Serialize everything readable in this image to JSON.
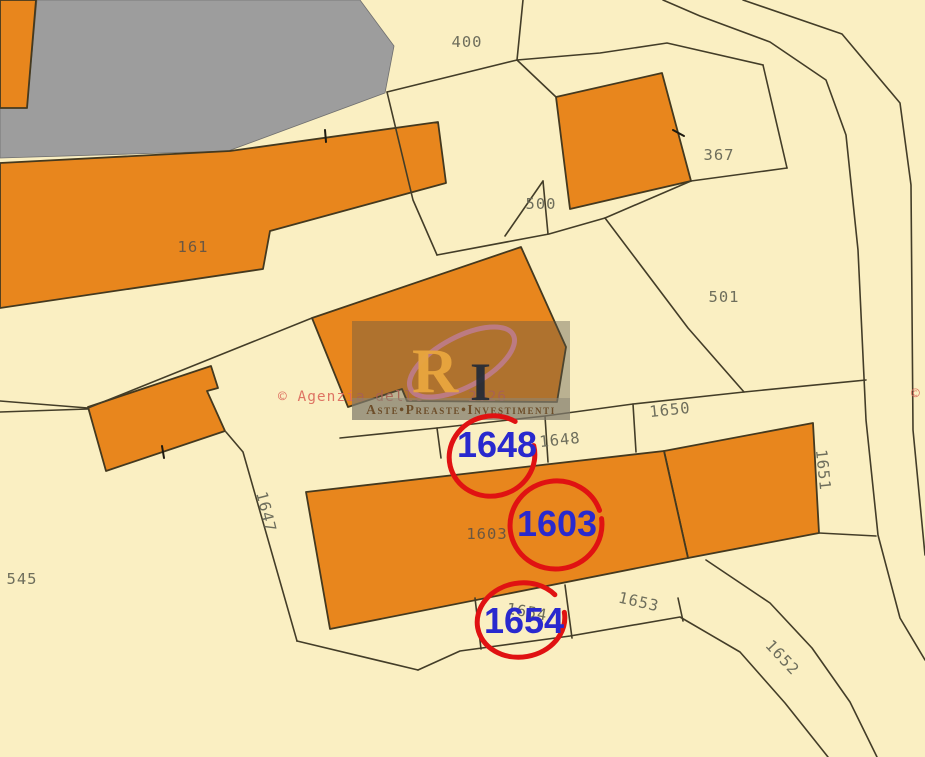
{
  "map": {
    "colors": {
      "background": "#FAEFC2",
      "building_fill": "#E8861D",
      "gray_area": "#9D9D9D",
      "boundary_line": "#433D28",
      "parcel_label": "#6E6E5C",
      "highlight_blue": "#2929CE",
      "circle_red": "#E01212",
      "watermark_red": "#DC6A5C"
    },
    "parcels": [
      {
        "id": "400",
        "label": "400"
      },
      {
        "id": "367",
        "label": "367"
      },
      {
        "id": "161",
        "label": "161"
      },
      {
        "id": "500",
        "label": "500"
      },
      {
        "id": "501",
        "label": "501"
      },
      {
        "id": "1650",
        "label": "1650"
      },
      {
        "id": "1648",
        "label": "1648"
      },
      {
        "id": "1651",
        "label": "1651"
      },
      {
        "id": "1647",
        "label": "1647"
      },
      {
        "id": "1603",
        "label": "1603"
      },
      {
        "id": "545",
        "label": "545"
      },
      {
        "id": "1654",
        "label": "1654"
      },
      {
        "id": "1653",
        "label": "1653"
      },
      {
        "id": "1652",
        "label": "1652"
      }
    ],
    "highlights": [
      {
        "label": "1648"
      },
      {
        "label": "1603"
      },
      {
        "label": "1654"
      }
    ],
    "watermark": {
      "copyright_left": "© Agenzia delle",
      "copyright_year": "2026",
      "copyright_symbol_right": "©",
      "logo_monogram_primary": "R",
      "logo_monogram_secondary": "I",
      "logo_caption": "Aste•Preaste•Investimenti"
    }
  }
}
